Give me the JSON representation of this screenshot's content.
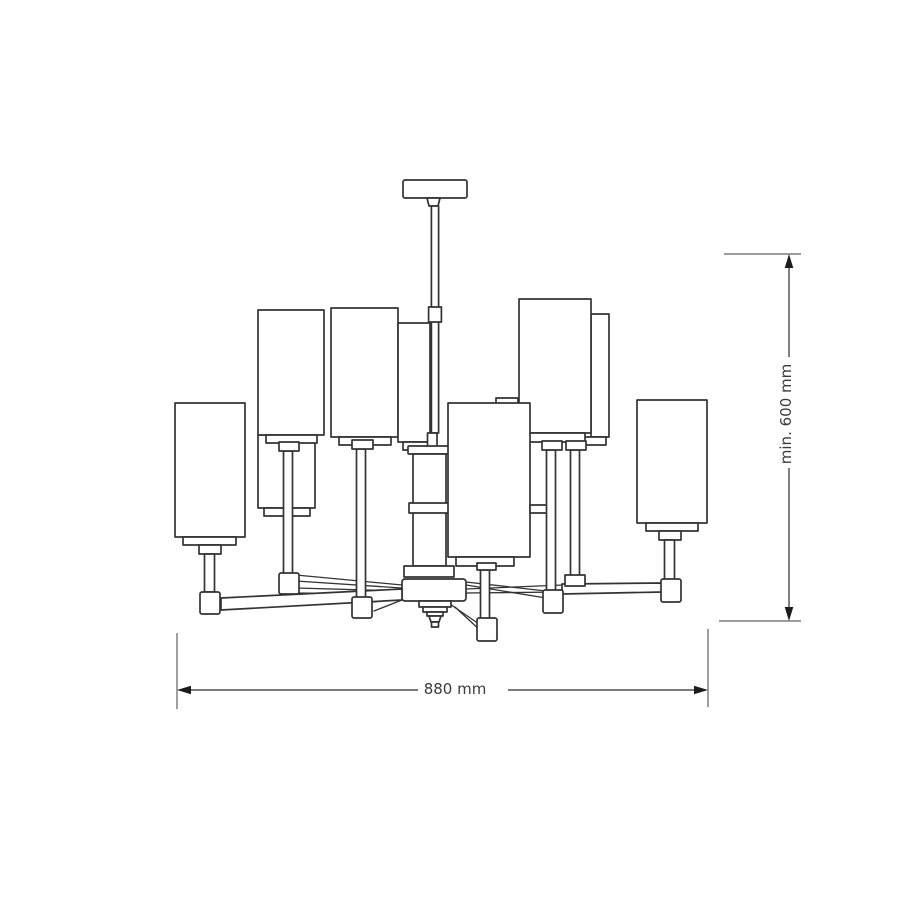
{
  "diagram": {
    "type": "technical dimension drawing",
    "subject": "two-tier chandelier, front elevation",
    "width_dimension": {
      "label": "880 mm"
    },
    "height_dimension": {
      "label": "min. 600 mm"
    },
    "colors": {
      "background": "#ffffff",
      "outline": "#333333",
      "dimension_line": "#2a2a2a",
      "dimension_arrow": "#1c1c1c",
      "extension_line": "#8f8f8f",
      "label_text": "#3a3a3a"
    }
  }
}
